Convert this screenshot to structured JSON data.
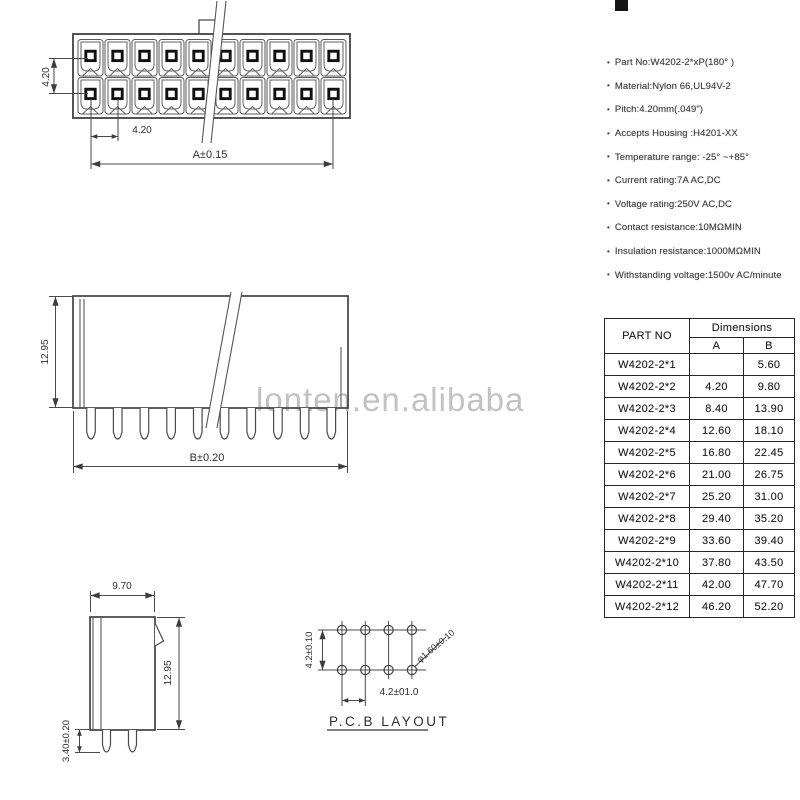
{
  "watermark": "lonten.en.alibaba",
  "specs": {
    "items": [
      "Part No:W4202-2*xP(180° )",
      "Material:Nylon 66,UL94V-2",
      "Pitch:4.20mm(.049\")",
      "Accepts Housing :H4201-XX",
      "Temperature range: -25° ~+85°",
      "Current rating:7A AC,DC",
      "Voltage rating:250V AC,DC",
      "Contact resistance:10MΩMIN",
      "Insulation resistance:1000MΩMIN",
      "Withstanding voltage:1500v AC/minute"
    ]
  },
  "table": {
    "headers": {
      "part": "PART NO",
      "dims": "Dimensions",
      "a": "A",
      "b": "B"
    },
    "rows": [
      {
        "part": "W4202-2*1",
        "a": "",
        "b": "5.60"
      },
      {
        "part": "W4202-2*2",
        "a": "4.20",
        "b": "9.80"
      },
      {
        "part": "W4202-2*3",
        "a": "8.40",
        "b": "13.90"
      },
      {
        "part": "W4202-2*4",
        "a": "12.60",
        "b": "18.10"
      },
      {
        "part": "W4202-2*5",
        "a": "16.80",
        "b": "22.45"
      },
      {
        "part": "W4202-2*6",
        "a": "21.00",
        "b": "26.75"
      },
      {
        "part": "W4202-2*7",
        "a": "25.20",
        "b": "31.00"
      },
      {
        "part": "W4202-2*8",
        "a": "29.40",
        "b": "35.20"
      },
      {
        "part": "W4202-2*9",
        "a": "33.60",
        "b": "39.40"
      },
      {
        "part": "W4202-2*10",
        "a": "37.80",
        "b": "43.50"
      },
      {
        "part": "W4202-2*11",
        "a": "42.00",
        "b": "47.70"
      },
      {
        "part": "W4202-2*12",
        "a": "46.20",
        "b": "52.20"
      }
    ]
  },
  "dimensions": {
    "front_pitch_vertical": "4.20",
    "front_pitch_horizontal": "4.20",
    "front_overall": "A±0.15",
    "side_height": "12.95",
    "side_overall": "B±0.20",
    "end_width": "9.70",
    "end_height": "12.95",
    "end_pin_length": "3.40±0.20",
    "pcb_pitch_vertical": "4.2±0.10",
    "pcb_pitch_horizontal": "4.2±01.0",
    "pcb_hole_diameter": "φ1.60±0.10",
    "pcb_title": "P.C.B  LAYOUT"
  },
  "drawing": {
    "front_columns": 10,
    "front_rows": 2,
    "side_pins": 10,
    "end_pins": 2,
    "pcb_columns": 4,
    "pcb_rows": 2
  }
}
